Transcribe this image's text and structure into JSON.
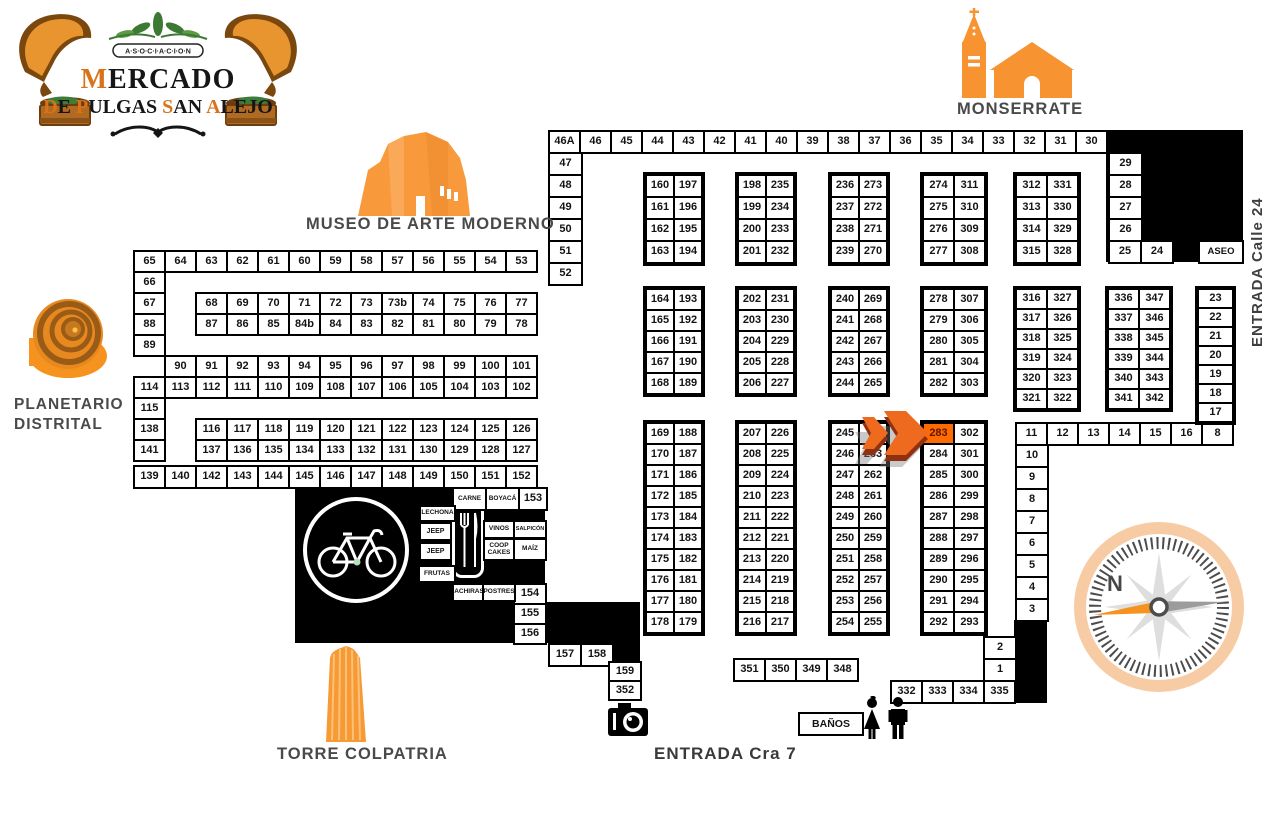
{
  "landmarks": {
    "monserrate": {
      "label": "MONSERRATE"
    },
    "museo": {
      "label": "MUSEO DE ARTE MODERNO"
    },
    "planetario": {
      "line1": "PLANETARIO",
      "line2": "DISTRITAL"
    },
    "torre": {
      "label": "TORRE COLPATRIA"
    },
    "entrada_calle": {
      "label": "ENTRADA Calle 24"
    },
    "entrada_cra": {
      "label": "ENTRADA Cra 7"
    },
    "compass": {
      "north": "N"
    },
    "logo": {
      "assoc": "A·S·O·C·I·A·C·I·O·N",
      "mercado_i": "M",
      "mercado_r": "ERCADO",
      "w1i": "D",
      "w1r": "E ",
      "w2i": "P",
      "w2r": "ULGAS ",
      "w3i": "S",
      "w3r": "AN ",
      "w4i": "A",
      "w4r": "LEJO"
    }
  },
  "colors": {
    "accent_orange": "#F6921E",
    "highlight_cell": "#FF6B00",
    "label_gray": "#4A4A4A"
  },
  "map": {
    "highlight": "283",
    "black_blocks": [
      {
        "name": "black-block-top-right",
        "x": 1106,
        "y": 130,
        "w": 137,
        "h": 132
      },
      {
        "name": "black-block-food-court",
        "x": 295,
        "y": 487,
        "w": 250,
        "h": 115
      },
      {
        "name": "black-block-food-step",
        "x": 295,
        "y": 602,
        "w": 313,
        "h": 41
      },
      {
        "name": "black-block-food-step2",
        "x": 608,
        "y": 602,
        "w": 32,
        "h": 59
      },
      {
        "name": "black-block-right-strip",
        "x": 1014,
        "y": 620,
        "w": 33,
        "h": 83
      }
    ],
    "groups": [
      {
        "id": "row-top",
        "x": 548,
        "y": 130,
        "pw": 31,
        "ph": 22,
        "rows": [
          [
            "46A",
            "46",
            "45",
            "44",
            "43",
            "42",
            "41",
            "40",
            "39",
            "38",
            "37",
            "36",
            "35",
            "34",
            "33",
            "32",
            "31",
            "30"
          ]
        ]
      },
      {
        "id": "col-47-52",
        "x": 548,
        "y": 152,
        "pw": 33,
        "ph": 22,
        "rows": [
          [
            "47"
          ],
          [
            "48"
          ],
          [
            "49"
          ],
          [
            "50"
          ],
          [
            "51"
          ],
          [
            "52"
          ]
        ]
      },
      {
        "id": "col-29-26",
        "x": 1108,
        "y": 152,
        "pw": 33,
        "ph": 22,
        "rows": [
          [
            "29"
          ],
          [
            "28"
          ],
          [
            "27"
          ],
          [
            "26"
          ]
        ]
      },
      {
        "id": "row-25-24",
        "x": 1108,
        "y": 240,
        "pw": 32,
        "ph": 22,
        "rows": [
          [
            "25",
            "24"
          ]
        ]
      },
      {
        "id": "cell-aseo",
        "x": 1198,
        "y": 240,
        "pw": 44,
        "ph": 22,
        "fs": 9.5,
        "kind": "facility",
        "rows": [
          [
            "ASEO"
          ]
        ]
      },
      {
        "id": "g160",
        "x": 645,
        "y": 174,
        "pw": 28,
        "ph": 22,
        "outline": true,
        "rows": [
          [
            "160",
            "197"
          ],
          [
            "161",
            "196"
          ],
          [
            "162",
            "195"
          ],
          [
            "163",
            "194"
          ]
        ]
      },
      {
        "id": "g198",
        "x": 737,
        "y": 174,
        "pw": 28,
        "ph": 22,
        "outline": true,
        "rows": [
          [
            "198",
            "235"
          ],
          [
            "199",
            "234"
          ],
          [
            "200",
            "233"
          ],
          [
            "201",
            "232"
          ]
        ]
      },
      {
        "id": "g236",
        "x": 830,
        "y": 174,
        "pw": 28,
        "ph": 22,
        "outline": true,
        "rows": [
          [
            "236",
            "273"
          ],
          [
            "237",
            "272"
          ],
          [
            "238",
            "271"
          ],
          [
            "239",
            "270"
          ]
        ]
      },
      {
        "id": "g274",
        "x": 922,
        "y": 174,
        "pw": 31,
        "ph": 22,
        "outline": true,
        "rows": [
          [
            "274",
            "311"
          ],
          [
            "275",
            "310"
          ],
          [
            "276",
            "309"
          ],
          [
            "277",
            "308"
          ]
        ]
      },
      {
        "id": "g312",
        "x": 1015,
        "y": 174,
        "pw": 31,
        "ph": 22,
        "outline": true,
        "rows": [
          [
            "312",
            "331"
          ],
          [
            "313",
            "330"
          ],
          [
            "314",
            "329"
          ],
          [
            "315",
            "328"
          ]
        ]
      },
      {
        "id": "block-left",
        "x": 133,
        "y": 250,
        "pw": 31,
        "ph": 21,
        "rows": [
          [
            "65",
            "64",
            "63",
            "62",
            "61",
            "60",
            "59",
            "58",
            "57",
            "56",
            "55",
            "54",
            "53"
          ],
          [
            "66"
          ],
          [
            "67",
            null,
            "68",
            "69",
            "70",
            "71",
            "72",
            "73",
            "73b",
            "74",
            "75",
            "76",
            "77"
          ],
          [
            "88",
            null,
            "87",
            "86",
            "85",
            "84b",
            "84",
            "83",
            "82",
            "81",
            "80",
            "79",
            "78"
          ],
          [
            "89"
          ],
          [
            null,
            "90",
            "91",
            "92",
            "93",
            "94",
            "95",
            "96",
            "97",
            "98",
            "99",
            "100",
            "101"
          ],
          [
            "114",
            "113",
            "112",
            "111",
            "110",
            "109",
            "108",
            "107",
            "106",
            "105",
            "104",
            "103",
            "102"
          ],
          [
            "115"
          ],
          [
            "138",
            null,
            "116",
            "117",
            "118",
            "119",
            "120",
            "121",
            "122",
            "123",
            "124",
            "125",
            "126"
          ],
          [
            "141",
            null,
            "137",
            "136",
            "135",
            "134",
            "133",
            "132",
            "131",
            "130",
            "129",
            "128",
            "127"
          ]
        ]
      },
      {
        "id": "g164",
        "x": 645,
        "y": 288,
        "pw": 28,
        "ph": 21,
        "outline": true,
        "rows": [
          [
            "164",
            "193"
          ],
          [
            "165",
            "192"
          ],
          [
            "166",
            "191"
          ],
          [
            "167",
            "190"
          ],
          [
            "168",
            "189"
          ]
        ]
      },
      {
        "id": "g202",
        "x": 737,
        "y": 288,
        "pw": 28,
        "ph": 21,
        "outline": true,
        "rows": [
          [
            "202",
            "231"
          ],
          [
            "203",
            "230"
          ],
          [
            "204",
            "229"
          ],
          [
            "205",
            "228"
          ],
          [
            "206",
            "227"
          ]
        ]
      },
      {
        "id": "g240",
        "x": 830,
        "y": 288,
        "pw": 28,
        "ph": 21,
        "outline": true,
        "rows": [
          [
            "240",
            "269"
          ],
          [
            "241",
            "268"
          ],
          [
            "242",
            "267"
          ],
          [
            "243",
            "266"
          ],
          [
            "244",
            "265"
          ]
        ]
      },
      {
        "id": "g278",
        "x": 922,
        "y": 288,
        "pw": 31,
        "ph": 21,
        "outline": true,
        "rows": [
          [
            "278",
            "307"
          ],
          [
            "279",
            "306"
          ],
          [
            "280",
            "305"
          ],
          [
            "281",
            "304"
          ],
          [
            "282",
            "303"
          ]
        ]
      },
      {
        "id": "g316",
        "x": 1015,
        "y": 288,
        "pw": 31,
        "ph": 20,
        "outline": true,
        "rows": [
          [
            "316",
            "327"
          ],
          [
            "317",
            "326"
          ],
          [
            "318",
            "325"
          ],
          [
            "319",
            "324"
          ],
          [
            "320",
            "323"
          ],
          [
            "321",
            "322"
          ]
        ]
      },
      {
        "id": "g336",
        "x": 1107,
        "y": 288,
        "pw": 31,
        "ph": 20,
        "outline": true,
        "rows": [
          [
            "336",
            "347"
          ],
          [
            "337",
            "346"
          ],
          [
            "338",
            "345"
          ],
          [
            "339",
            "344"
          ],
          [
            "340",
            "343"
          ],
          [
            "341",
            "342"
          ]
        ]
      },
      {
        "id": "col-23-17",
        "x": 1197,
        "y": 288,
        "pw": 35,
        "ph": 19,
        "outline": true,
        "rows": [
          [
            "23"
          ],
          [
            "22"
          ],
          [
            "21"
          ],
          [
            "20"
          ],
          [
            "19"
          ],
          [
            "18"
          ],
          [
            "17"
          ]
        ]
      },
      {
        "id": "g169",
        "x": 645,
        "y": 422,
        "pw": 28,
        "ph": 21,
        "outline": true,
        "rows": [
          [
            "169",
            "188"
          ],
          [
            "170",
            "187"
          ],
          [
            "171",
            "186"
          ],
          [
            "172",
            "185"
          ],
          [
            "173",
            "184"
          ],
          [
            "174",
            "183"
          ],
          [
            "175",
            "182"
          ],
          [
            "176",
            "181"
          ],
          [
            "177",
            "180"
          ],
          [
            "178",
            "179"
          ]
        ]
      },
      {
        "id": "g207",
        "x": 737,
        "y": 422,
        "pw": 28,
        "ph": 21,
        "outline": true,
        "rows": [
          [
            "207",
            "226"
          ],
          [
            "208",
            "225"
          ],
          [
            "209",
            "224"
          ],
          [
            "210",
            "223"
          ],
          [
            "211",
            "222"
          ],
          [
            "212",
            "221"
          ],
          [
            "213",
            "220"
          ],
          [
            "214",
            "219"
          ],
          [
            "215",
            "218"
          ],
          [
            "216",
            "217"
          ]
        ]
      },
      {
        "id": "g245",
        "x": 830,
        "y": 422,
        "pw": 28,
        "ph": 21,
        "outline": true,
        "rows": [
          [
            "245",
            ""
          ],
          [
            "246",
            "263"
          ],
          [
            "247",
            "262"
          ],
          [
            "248",
            "261"
          ],
          [
            "249",
            "260"
          ],
          [
            "250",
            "259"
          ],
          [
            "251",
            "258"
          ],
          [
            "252",
            "257"
          ],
          [
            "253",
            "256"
          ],
          [
            "254",
            "255"
          ]
        ]
      },
      {
        "id": "g283",
        "x": 922,
        "y": 422,
        "pw": 31,
        "ph": 21,
        "outline": true,
        "rows": [
          [
            "283",
            "302"
          ],
          [
            "284",
            "301"
          ],
          [
            "285",
            "300"
          ],
          [
            "286",
            "299"
          ],
          [
            "287",
            "298"
          ],
          [
            "288",
            "297"
          ],
          [
            "289",
            "296"
          ],
          [
            "290",
            "295"
          ],
          [
            "291",
            "294"
          ],
          [
            "292",
            "293"
          ]
        ]
      },
      {
        "id": "row-11-8",
        "x": 1015,
        "y": 422,
        "pw": 31,
        "ph": 22,
        "rows": [
          [
            "11",
            "12",
            "13",
            "14",
            "15",
            "16",
            "8"
          ]
        ]
      },
      {
        "id": "col-10-3",
        "x": 1015,
        "y": 444,
        "pw": 32,
        "ph": 22,
        "rows": [
          [
            "10"
          ],
          [
            "9"
          ],
          [
            "8"
          ],
          [
            "7"
          ],
          [
            "6"
          ],
          [
            "5"
          ],
          [
            "4"
          ],
          [
            "3"
          ]
        ]
      },
      {
        "id": "row-139",
        "x": 133,
        "y": 465,
        "pw": 31,
        "ph": 22,
        "rows": [
          [
            "139",
            "140",
            "142",
            "143",
            "144",
            "145",
            "146",
            "147",
            "148",
            "149",
            "150",
            "151",
            "152"
          ]
        ]
      },
      {
        "id": "row-carne",
        "x": 452,
        "y": 487,
        "pw": 33,
        "ph": 22,
        "fs": 6.5,
        "kind": "vendor",
        "rows": [
          [
            "CARNE",
            "BOYACÁ"
          ]
        ]
      },
      {
        "id": "cell-153",
        "x": 518,
        "y": 487,
        "pw": 28,
        "ph": 22,
        "rows": [
          [
            "153"
          ]
        ]
      },
      {
        "id": "col-154",
        "x": 513,
        "y": 583,
        "pw": 32,
        "ph": 20,
        "rows": [
          [
            "154"
          ],
          [
            "155"
          ],
          [
            "156"
          ]
        ]
      },
      {
        "id": "row-157",
        "x": 548,
        "y": 643,
        "pw": 32,
        "ph": 22,
        "rows": [
          [
            "157",
            "158"
          ]
        ]
      },
      {
        "id": "col-159",
        "x": 608,
        "y": 661,
        "pw": 32,
        "ph": 19,
        "rows": [
          [
            "159"
          ],
          [
            "352"
          ]
        ]
      },
      {
        "id": "row-351",
        "x": 733,
        "y": 658,
        "pw": 31,
        "ph": 22,
        "rows": [
          [
            "351",
            "350",
            "349",
            "348"
          ]
        ]
      },
      {
        "id": "row-332",
        "x": 890,
        "y": 680,
        "pw": 31,
        "ph": 22,
        "rows": [
          [
            "332",
            "333",
            "334",
            "335"
          ]
        ]
      },
      {
        "id": "col-2-1",
        "x": 983,
        "y": 636,
        "pw": 32,
        "ph": 22,
        "rows": [
          [
            "2"
          ],
          [
            "1"
          ]
        ]
      },
      {
        "id": "cell-banos",
        "x": 798,
        "y": 712,
        "pw": 64,
        "ph": 22,
        "fs": 10.5,
        "kind": "facility",
        "rows": [
          [
            "BAÑOS"
          ]
        ]
      },
      {
        "id": "lbl-lechona",
        "x": 419,
        "y": 505,
        "pw": 35,
        "ph": 15,
        "fs": 6.5,
        "kind": "vendor",
        "rows": [
          [
            "LECHONA"
          ]
        ]
      },
      {
        "id": "lbl-jeep1",
        "x": 419,
        "y": 522,
        "pw": 31,
        "ph": 17,
        "fs": 7,
        "kind": "vendor",
        "rows": [
          [
            "JEEP"
          ]
        ]
      },
      {
        "id": "lbl-jeep2",
        "x": 419,
        "y": 542,
        "pw": 31,
        "ph": 17,
        "fs": 7,
        "kind": "vendor",
        "rows": [
          [
            "JEEP"
          ]
        ]
      },
      {
        "id": "lbl-frutas",
        "x": 418,
        "y": 565,
        "pw": 36,
        "ph": 16,
        "fs": 6.5,
        "kind": "vendor",
        "rows": [
          [
            "FRUTAS"
          ]
        ]
      },
      {
        "id": "lbl-vinos",
        "x": 483,
        "y": 520,
        "pw": 30,
        "ph": 17,
        "fs": 6.5,
        "kind": "vendor",
        "rows": [
          [
            "VINOS"
          ]
        ]
      },
      {
        "id": "lbl-salpicon",
        "x": 513,
        "y": 520,
        "pw": 32,
        "ph": 17,
        "fs": 5.5,
        "kind": "vendor",
        "rows": [
          [
            "SALPICÓN"
          ]
        ]
      },
      {
        "id": "lbl-coopcakes",
        "x": 483,
        "y": 538,
        "pw": 30,
        "ph": 21,
        "fs": 6.5,
        "kind": "vendor",
        "rows": [
          [
            "COOP\nCAKES"
          ]
        ]
      },
      {
        "id": "lbl-maiz",
        "x": 513,
        "y": 538,
        "pw": 32,
        "ph": 21,
        "fs": 6.5,
        "kind": "vendor",
        "rows": [
          [
            "MAÍZ"
          ]
        ]
      },
      {
        "id": "lbl-achiras",
        "x": 452,
        "y": 583,
        "pw": 32,
        "ph": 17,
        "fs": 6.5,
        "kind": "vendor",
        "rows": [
          [
            "ACHIRAS"
          ]
        ]
      },
      {
        "id": "lbl-postres",
        "x": 482,
        "y": 583,
        "pw": 32,
        "ph": 17,
        "fs": 6.5,
        "kind": "vendor",
        "rows": [
          [
            "POSTRES"
          ]
        ]
      }
    ]
  }
}
